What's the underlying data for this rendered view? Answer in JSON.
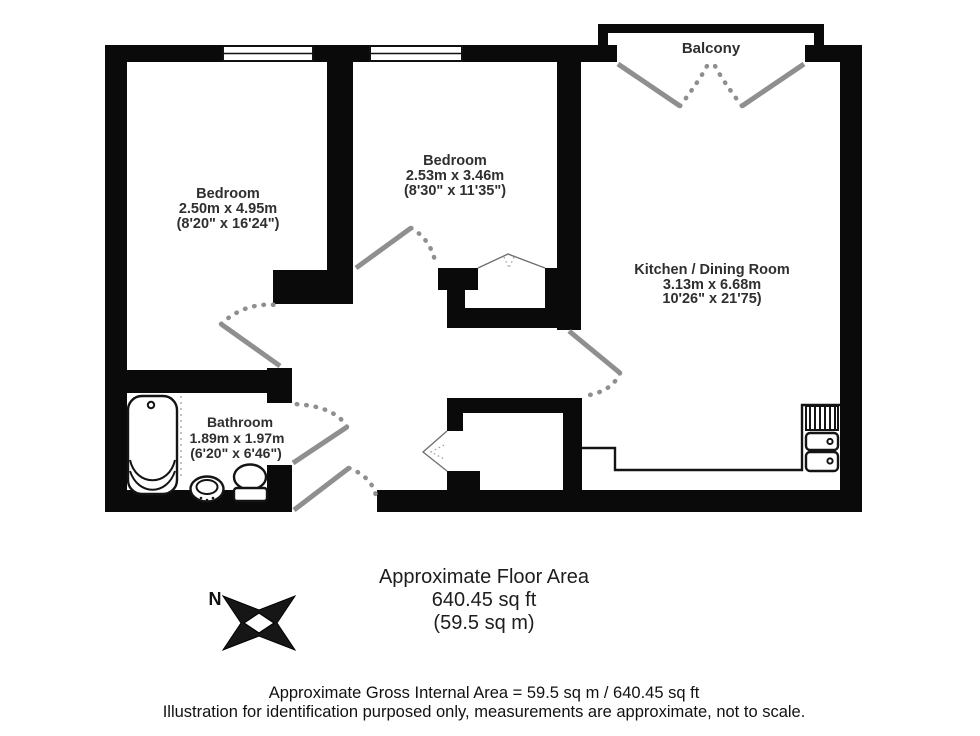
{
  "rooms": {
    "bedroom_left": {
      "name": "Bedroom",
      "metric": "2.50m x 4.95m",
      "imperial": "(8'20\" x 16'24\")"
    },
    "bedroom_mid": {
      "name": "Bedroom",
      "metric": "2.53m x 3.46m",
      "imperial": "(8'30\" x 11'35\")"
    },
    "kitchen": {
      "name": "Kitchen / Dining Room",
      "metric": "3.13m x 6.68m",
      "imperial": "10'26\" x 21'75)"
    },
    "bathroom": {
      "name": "Bathroom",
      "metric": "1.89m x 1.97m",
      "imperial": "(6'20\" x 6'46\")"
    },
    "balcony": {
      "name": "Balcony"
    }
  },
  "compass": {
    "north": "N"
  },
  "area": {
    "heading": "Approximate Floor Area",
    "imperial": "640.45 sq ft",
    "metric": "(59.5 sq m)"
  },
  "footer": {
    "line1": "Approximate Gross Internal Area = 59.5 sq m / 640.45 sq ft",
    "line2": "Illustration for identification purposed only, measurements are approximate, not to scale."
  },
  "colors": {
    "wall": "#0a0a0a",
    "door": "#8f8f8f",
    "label_text": "#2f2f2f",
    "footer_text": "#111111",
    "background": "#ffffff"
  }
}
